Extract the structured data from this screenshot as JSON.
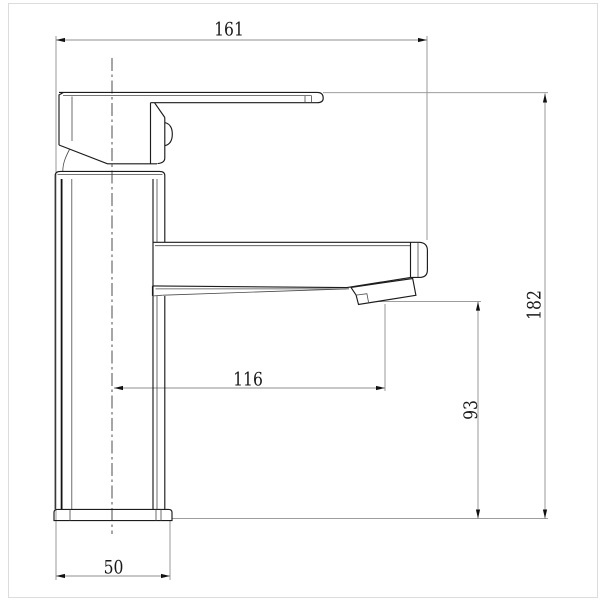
{
  "drawing": {
    "title": "faucet-technical-drawing-side-view",
    "colors": {
      "background": "#ffffff",
      "outline": "#1c1c1c",
      "dimension_lines": "#8f8f8f",
      "text": "#1a1a1a",
      "frame": "#dcdcdc"
    },
    "dimensions": {
      "overall_length": {
        "label": "161"
      },
      "overall_height": {
        "label": "182"
      },
      "spout_reach": {
        "label": "116"
      },
      "outlet_height": {
        "label": "93"
      },
      "base_width": {
        "label": "50"
      }
    }
  }
}
